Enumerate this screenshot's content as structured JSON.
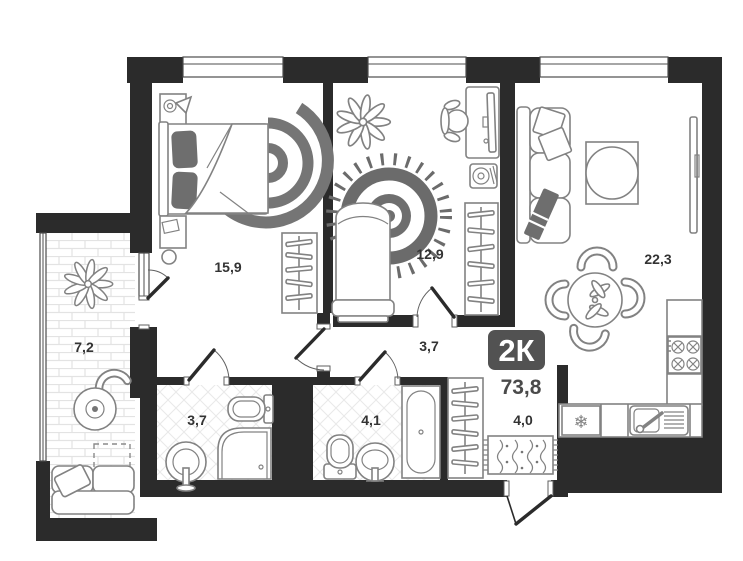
{
  "plan": {
    "type_badge": "2К",
    "total_area": "73,8",
    "rooms": {
      "bedroom": {
        "name": "bedroom",
        "area": "15,9"
      },
      "bedroom2": {
        "name": "second-room",
        "area": "12,9"
      },
      "living_kitchen": {
        "name": "living-kitchen",
        "area": "22,3"
      },
      "balcony": {
        "name": "balcony",
        "area": "7,2"
      },
      "bathroom_ensuite": {
        "name": "ensuite-bathroom",
        "area": "3,7"
      },
      "hallway": {
        "name": "hallway",
        "area": "3,7"
      },
      "bathroom": {
        "name": "bathroom",
        "area": "4,1"
      },
      "entry": {
        "name": "entry-hall",
        "area": "4,0"
      }
    },
    "icons": {
      "fridge_glyph": "❄"
    },
    "colors": {
      "walls": "#2b2b2b",
      "furniture_stroke": "#828282",
      "furniture_accent": "#6e6e6e",
      "badge_bg": "#525252",
      "badge_text": "#ffffff",
      "area_label": "#333333"
    }
  }
}
